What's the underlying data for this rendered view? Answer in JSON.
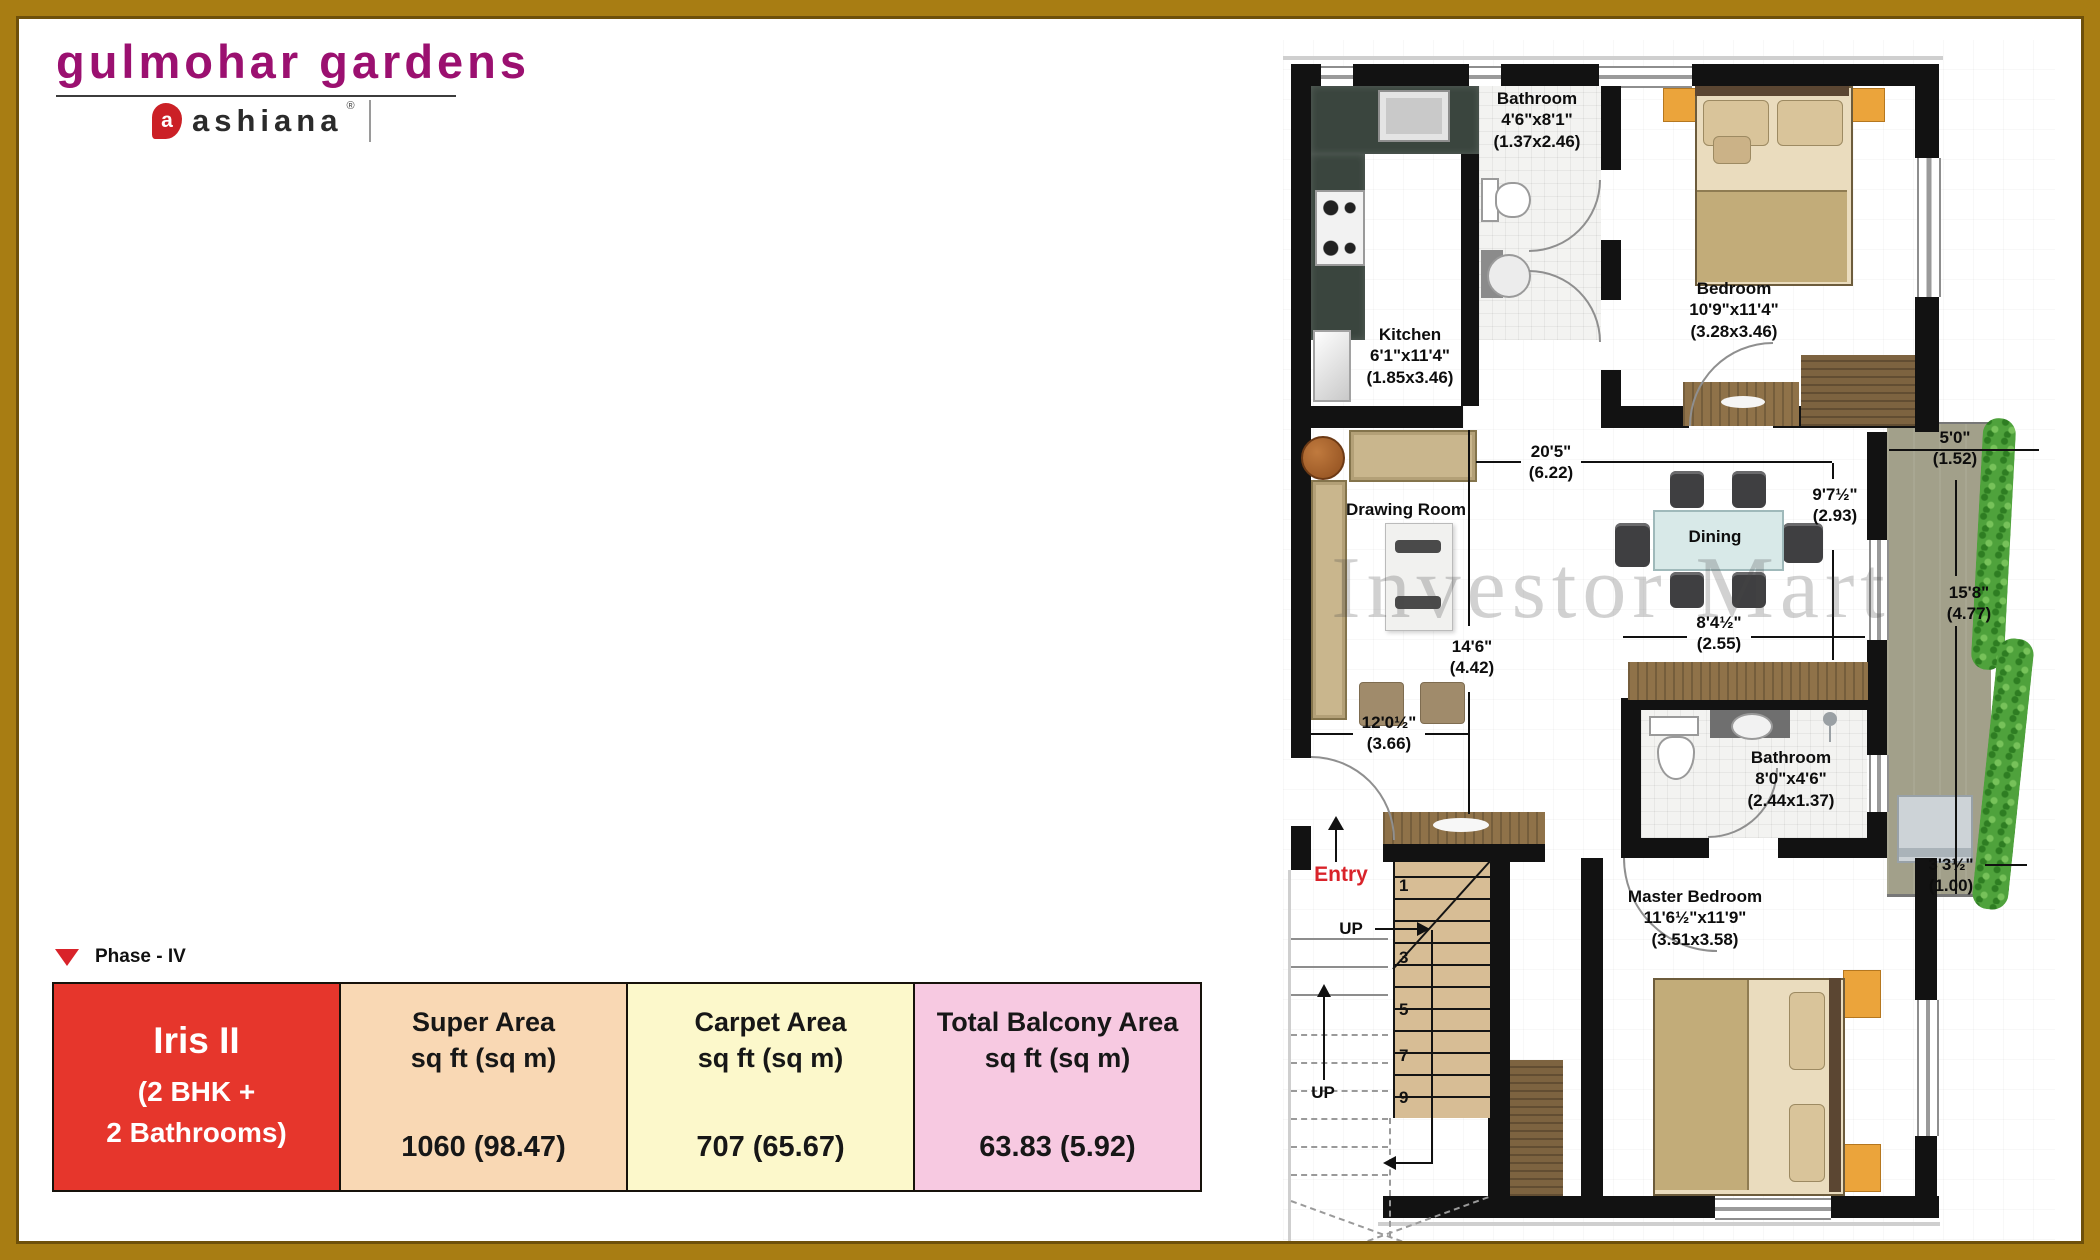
{
  "header": {
    "brand": "gulmohar gardens",
    "logo_text": "ashiana",
    "logo_reg": "®",
    "logo_initial": "a"
  },
  "phase": {
    "label": "Phase - IV"
  },
  "summary_table": {
    "unit": {
      "name": "Iris II",
      "config_line1": "(2 BHK +",
      "config_line2": "2 Bathrooms)",
      "bg": "#E6362C"
    },
    "columns": [
      {
        "header_line1": "Super Area",
        "header_line2": "sq ft (sq m)",
        "value": "1060 (98.47)",
        "bg": "#F9D8B4"
      },
      {
        "header_line1": "Carpet Area",
        "header_line2": "sq ft (sq m)",
        "value": "707 (65.67)",
        "bg": "#FCF8CB"
      },
      {
        "header_line1": "Total Balcony Area",
        "header_line2": "sq ft (sq m)",
        "value": "63.83 (5.92)",
        "bg": "#F7C9E1"
      }
    ]
  },
  "plan": {
    "watermark": "Investor Mart",
    "entry_label": "Entry",
    "up_label": "UP",
    "stair_numbers": [
      "1",
      "3",
      "5",
      "7",
      "9"
    ],
    "rooms": {
      "kitchen": {
        "name": "Kitchen",
        "ft": "6'1\"x11'4\"",
        "m": "(1.85x3.46)"
      },
      "bathroom1": {
        "name": "Bathroom",
        "ft": "4'6\"x8'1\"",
        "m": "(1.37x2.46)"
      },
      "bedroom": {
        "name": "Bedroom",
        "ft": "10'9\"x11'4\"",
        "m": "(3.28x3.46)"
      },
      "drawing_room": {
        "name": "Drawing Room"
      },
      "dining": {
        "name": "Dining"
      },
      "bathroom2": {
        "name": "Bathroom",
        "ft": "8'0\"x4'6\"",
        "m": "(2.44x1.37)"
      },
      "master_bedroom": {
        "name": "Master Bedroom",
        "ft": "11'6½\"x11'9\"",
        "m": "(3.51x3.58)"
      }
    },
    "dims": {
      "d20": {
        "ft": "20'5\"",
        "m": "(6.22)"
      },
      "d14": {
        "ft": "14'6\"",
        "m": "(4.42)"
      },
      "d12": {
        "ft": "12'0½\"",
        "m": "(3.66)"
      },
      "d9": {
        "ft": "9'7½\"",
        "m": "(2.93)"
      },
      "d8": {
        "ft": "8'4½\"",
        "m": "(2.55)"
      },
      "d5": {
        "ft": "5'0\"",
        "m": "(1.52)"
      },
      "d15": {
        "ft": "15'8\"",
        "m": "(4.77)"
      },
      "d3": {
        "ft": "3'3½\"",
        "m": "(1.00)"
      }
    },
    "colors": {
      "accent_red": "#D9232A",
      "brand_magenta": "#9B1070",
      "wall": "#121212",
      "balcony_floor": "#A2A08A",
      "hedge_green": "#4FA23C"
    }
  }
}
